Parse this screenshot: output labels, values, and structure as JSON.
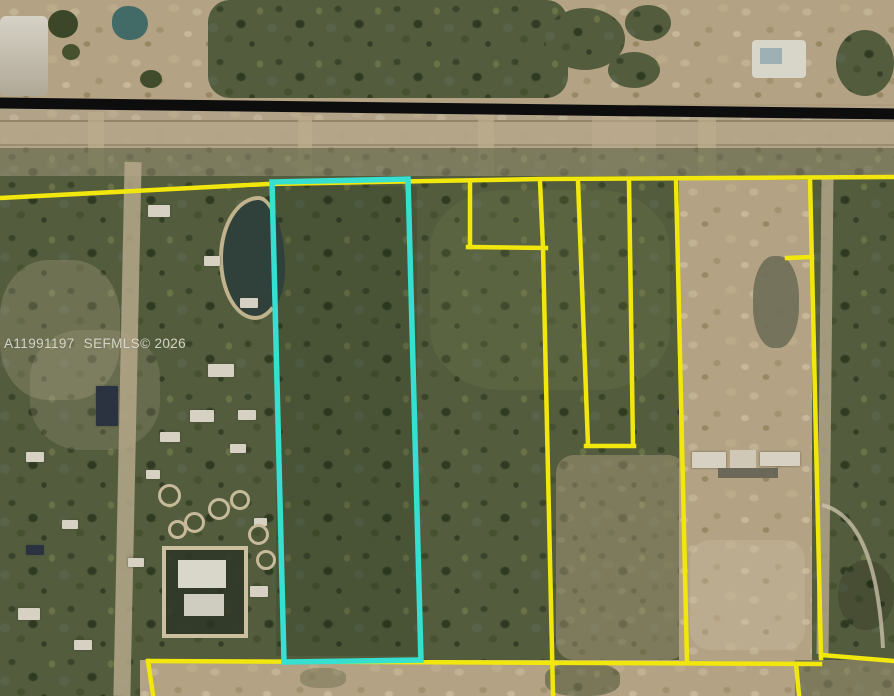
{
  "watermark": {
    "mls_number": "A11991197",
    "source": "SEFMLS©",
    "year": "2026",
    "full_text": "A11991197 SEFMLS© 2026"
  },
  "map": {
    "kind": "aerial-satellite-parcel-view",
    "highlighted_parcel_outline_px": "272,182 408,179 421,660 284,662"
  },
  "colors": {
    "highlight_cyan": "#35E0D0",
    "parcel_yellow": "#F2E70C",
    "road_black": "#0D0D0D",
    "watermark_gray": "#E4E4D8"
  }
}
